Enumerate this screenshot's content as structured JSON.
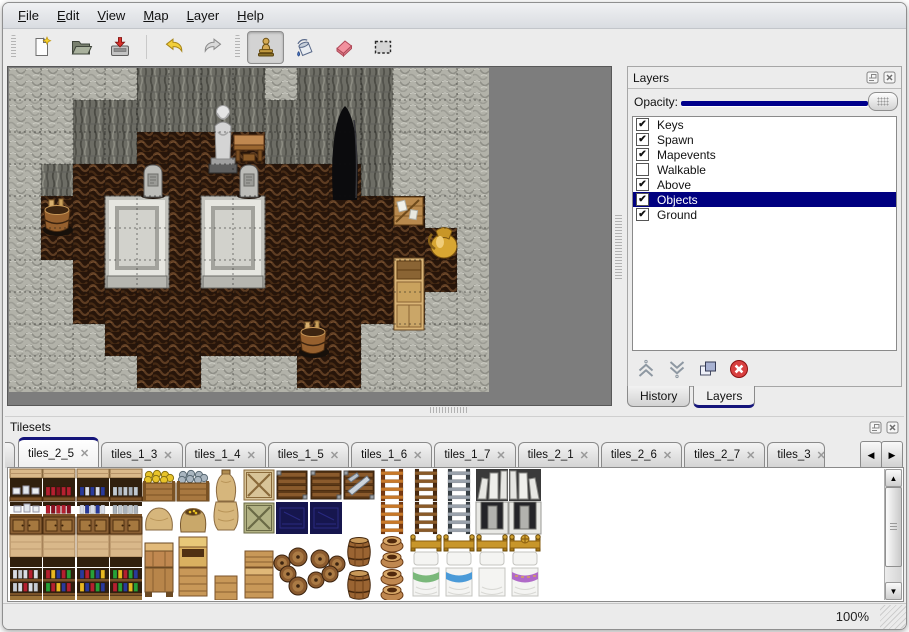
{
  "window": {
    "status_zoom": "100%"
  },
  "menu_bar": {
    "items": [
      {
        "label": "File"
      },
      {
        "label": "Edit"
      },
      {
        "label": "View"
      },
      {
        "label": "Map"
      },
      {
        "label": "Layer"
      },
      {
        "label": "Help"
      }
    ]
  },
  "toolbar": {
    "buttons": [
      {
        "icon": "new-file-icon",
        "group": 1,
        "active": false
      },
      {
        "icon": "open-file-icon",
        "group": 1,
        "active": false
      },
      {
        "icon": "save-file-icon",
        "group": 1,
        "active": false
      },
      {
        "icon": "undo-icon",
        "group": 2,
        "active": false
      },
      {
        "icon": "redo-icon",
        "group": 2,
        "active": false
      },
      {
        "icon": "stamp-tool-icon",
        "group": 3,
        "active": true
      },
      {
        "icon": "fill-tool-icon",
        "group": 3,
        "active": false
      },
      {
        "icon": "eraser-tool-icon",
        "group": 3,
        "active": false
      },
      {
        "icon": "select-tool-icon",
        "group": 3,
        "active": false
      }
    ]
  },
  "map_view": {
    "tile_size": 32,
    "tiles": [
      "LLLLDDDDLDDDLLL",
      "LLDDDDDDDDDDLLL",
      "LLDDFFFFDDDDLLL",
      "LDFFFFFFFFFDLLL",
      "LFFFFFFFFFFFFLL",
      "LFFFFFFFFFFFFFL",
      "LLFFFFFFFFFFFFL",
      "LLFFFFFFFFFFFLL",
      "LLLFFFFFFFFLLLL",
      "LLLLFFLLLFFLLLL",
      "LLLLLLLLLLLLLLL"
    ],
    "objects": [
      {
        "type": "cave",
        "x": 320,
        "y": 30
      },
      {
        "type": "tomb",
        "x": 96,
        "y": 128
      },
      {
        "type": "tomb",
        "x": 192,
        "y": 128
      },
      {
        "type": "grave",
        "x": 128,
        "y": 92
      },
      {
        "type": "grave",
        "x": 224,
        "y": 92
      },
      {
        "type": "statue",
        "x": 198,
        "y": 30
      },
      {
        "type": "table",
        "x": 224,
        "y": 64
      },
      {
        "type": "crates",
        "x": 384,
        "y": 126
      },
      {
        "type": "jug",
        "x": 418,
        "y": 156
      },
      {
        "type": "shelf",
        "x": 385,
        "y": 190
      },
      {
        "type": "barrel",
        "x": 32,
        "y": 130
      },
      {
        "type": "barrel",
        "x": 288,
        "y": 252
      }
    ]
  },
  "layers_panel": {
    "title": "Layers",
    "opacity_label": "Opacity:",
    "opacity_percent": 100,
    "layers": [
      {
        "name": "Keys",
        "checked": true,
        "selected": false
      },
      {
        "name": "Spawn",
        "checked": true,
        "selected": false
      },
      {
        "name": "Mapevents",
        "checked": true,
        "selected": false
      },
      {
        "name": "Walkable",
        "checked": false,
        "selected": false
      },
      {
        "name": "Above",
        "checked": true,
        "selected": false
      },
      {
        "name": "Objects",
        "checked": true,
        "selected": true
      },
      {
        "name": "Ground",
        "checked": true,
        "selected": false
      }
    ],
    "action_buttons": [
      {
        "icon": "raise-layer-icon"
      },
      {
        "icon": "lower-layer-icon"
      },
      {
        "icon": "duplicate-layer-icon"
      },
      {
        "icon": "delete-layer-icon"
      }
    ],
    "tabs": [
      {
        "label": "History",
        "active": false
      },
      {
        "label": "Layers",
        "active": true
      }
    ]
  },
  "tilesets_panel": {
    "title": "Tilesets",
    "tabs": [
      {
        "label": "tiles_2_5",
        "active": true,
        "truncated": false
      },
      {
        "label": "tiles_1_3",
        "active": false,
        "truncated": false
      },
      {
        "label": "tiles_1_4",
        "active": false,
        "truncated": false
      },
      {
        "label": "tiles_1_5",
        "active": false,
        "truncated": false
      },
      {
        "label": "tiles_1_6",
        "active": false,
        "truncated": false
      },
      {
        "label": "tiles_1_7",
        "active": false,
        "truncated": false
      },
      {
        "label": "tiles_2_1",
        "active": false,
        "truncated": false
      },
      {
        "label": "tiles_2_6",
        "active": false,
        "truncated": false
      },
      {
        "label": "tiles_2_7",
        "active": false,
        "truncated": false
      },
      {
        "label": "tiles_3",
        "active": false,
        "truncated": true
      }
    ],
    "tile_grid": [
      [
        "shelf_dishes_top",
        "shelf_red_top",
        "shelf_blue_top",
        "shelf_jars_top",
        "bin_corn",
        "bin_fish",
        "sack_tall_top",
        "crate_x",
        "crate_slat",
        "crate_slat",
        "crate_metal",
        "ladder_orange",
        "ladder_brown",
        "ladder_gray",
        "arch_left_top",
        "arch_right_top"
      ],
      [
        "shelf_dishes_bot",
        "shelf_red_bot",
        "shelf_blue_bot",
        "shelf_jars_bot",
        "sack_wide",
        "sack_open",
        "sack_tall_bot",
        "crate_x_green",
        "crate_navy",
        "crate_navy",
        "empty",
        "ladder_orange",
        "ladder_brown",
        "ladder_gray",
        "arch_left_bot",
        "arch_right_bot"
      ],
      [
        "plank_top",
        "plank_top",
        "plank_top",
        "plank_top",
        "counter_top",
        "hutch_top",
        "empty",
        "crate_half",
        "barrel_pile_tl",
        "barrel_pile_tr",
        "barrel_upright",
        "pots",
        "bed_head",
        "bed_head",
        "bed_head",
        "bed_head_ornate"
      ],
      [
        "shelf_potions1",
        "shelf_potions2",
        "shelf_potions3",
        "shelf_potions4",
        "counter_bot",
        "hutch_bot",
        "crate_small",
        "crate_plain",
        "barrel_pile_bl",
        "barrel_pile_br",
        "barrel_upright",
        "pots",
        "bed_foot_green",
        "bed_foot_blue",
        "bed_foot_white",
        "bed_foot_purple"
      ]
    ]
  },
  "colors": {
    "selection_navy": "#000080",
    "slider_navy": "#00008b",
    "tab_accent_navy": "#14147a"
  }
}
